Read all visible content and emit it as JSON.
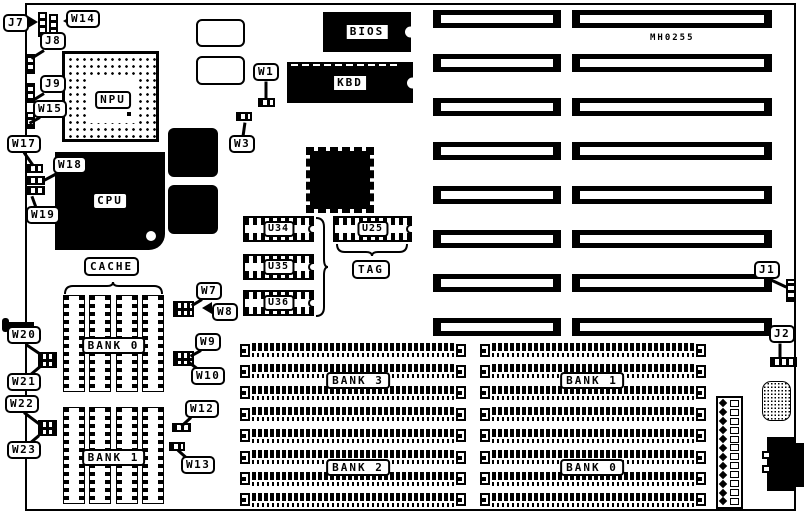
{
  "board": {
    "part_number": "MH0255"
  },
  "chips": {
    "bios": "BIOS",
    "kbd": "KBD",
    "npu": "NPU",
    "cpu": "CPU"
  },
  "sockets": {
    "u34": "U34",
    "u35": "U35",
    "u36": "U36",
    "u25": "U25",
    "tag": "TAG"
  },
  "cache": {
    "title": "CACHE",
    "bank0": "BANK 0",
    "bank1": "BANK 1"
  },
  "memory": {
    "bank3": "BANK 3",
    "bank2": "BANK 2",
    "bank1": "BANK 1",
    "bank0": "BANK 0"
  },
  "callouts": {
    "j7": "J7",
    "w14": "W14",
    "j8": "J8",
    "j9": "J9",
    "w15": "W15",
    "w17": "W17",
    "w18": "W18",
    "w19": "W19",
    "w1": "W1",
    "w3": "W3",
    "w7": "W7",
    "w8": "W8",
    "w9": "W9",
    "w10": "W10",
    "w12": "W12",
    "w13": "W13",
    "w20": "W20",
    "w21": "W21",
    "w22": "W22",
    "w23": "W23",
    "j1": "J1",
    "j2": "J2"
  },
  "counts": {
    "isa_slot_rows": 8,
    "isa_slot_columns": 2,
    "simm_rows_per_module": 8,
    "cache_chips_per_bank": 4,
    "power_pins": 12
  }
}
